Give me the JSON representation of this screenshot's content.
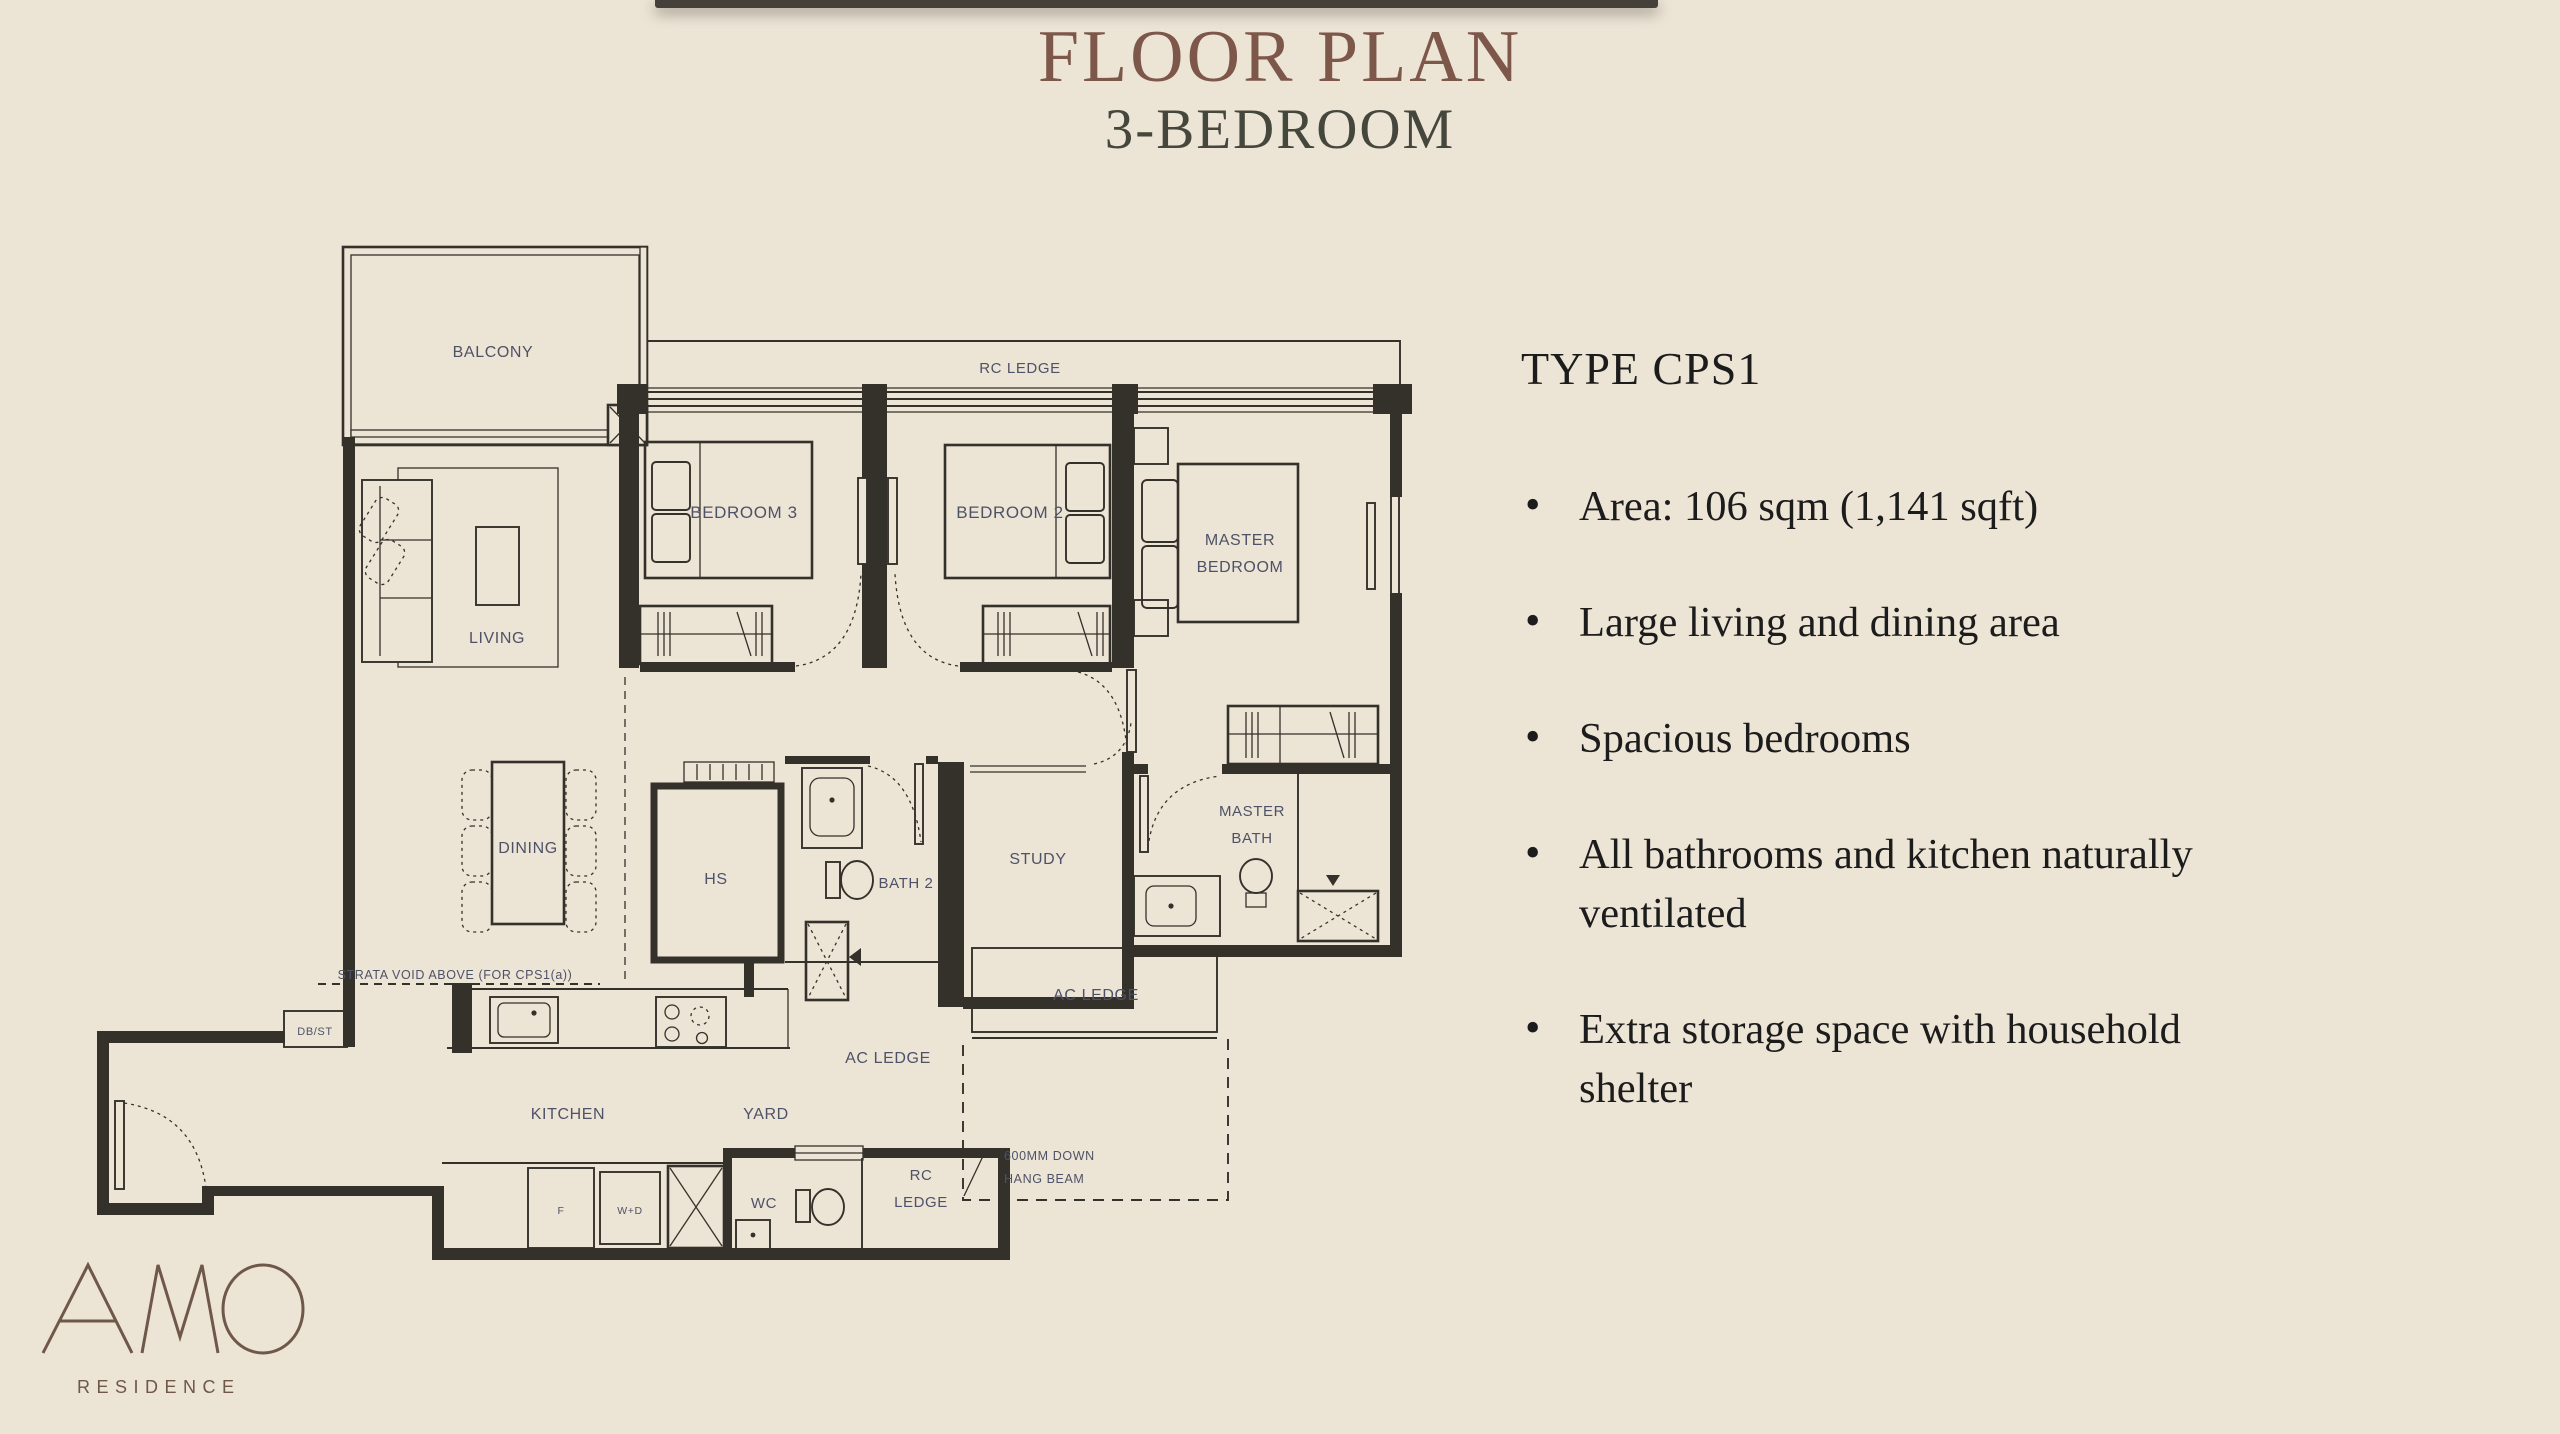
{
  "theme": {
    "background": "#ece4d5",
    "line": "#34312b",
    "room_label": "#4e5268",
    "title": "#7d574a",
    "subtitle": "#45463c",
    "body_text": "#1c1c1c",
    "logo": "#6f574a",
    "top_bar": "#454039"
  },
  "header": {
    "title": "FLOOR PLAN",
    "subtitle": "3-BEDROOM"
  },
  "details": {
    "type_label": "TYPE CPS1",
    "bullets": [
      [
        "Area: 106 sqm (1,141 sqft)"
      ],
      [
        "Large living and dining area"
      ],
      [
        "Spacious bedrooms"
      ],
      [
        "All bathrooms and kitchen naturally",
        "ventilated"
      ],
      [
        "Extra storage space with household",
        "shelter"
      ]
    ]
  },
  "plan": {
    "labels": {
      "balcony": "BALCONY",
      "rc_ledge_top": "RC LEDGE",
      "bedroom3": "BEDROOM 3",
      "bedroom2": "BEDROOM 2",
      "master_bedroom_1": "MASTER",
      "master_bedroom_2": "BEDROOM",
      "living": "LIVING",
      "dining": "DINING",
      "hs": "HS",
      "bath2": "BATH 2",
      "study": "STUDY",
      "master_bath_1": "MASTER",
      "master_bath_2": "BATH",
      "ac_ledge_right": "AC LEDGE",
      "ac_ledge_left": "AC LEDGE",
      "strata_void": "STRATA VOID ABOVE (FOR CPS1(a))",
      "dbst": "DB/ST",
      "kitchen": "KITCHEN",
      "yard": "YARD",
      "wc": "WC",
      "rc_ledge_bottom_1": "RC",
      "rc_ledge_bottom_2": "LEDGE",
      "hang_beam_1": "600MM DOWN",
      "hang_beam_2": "HANG BEAM",
      "fridge": "F",
      "washer_dryer": "W+D"
    }
  },
  "logo": {
    "name": "AMO",
    "subtitle": "RESIDENCE"
  }
}
